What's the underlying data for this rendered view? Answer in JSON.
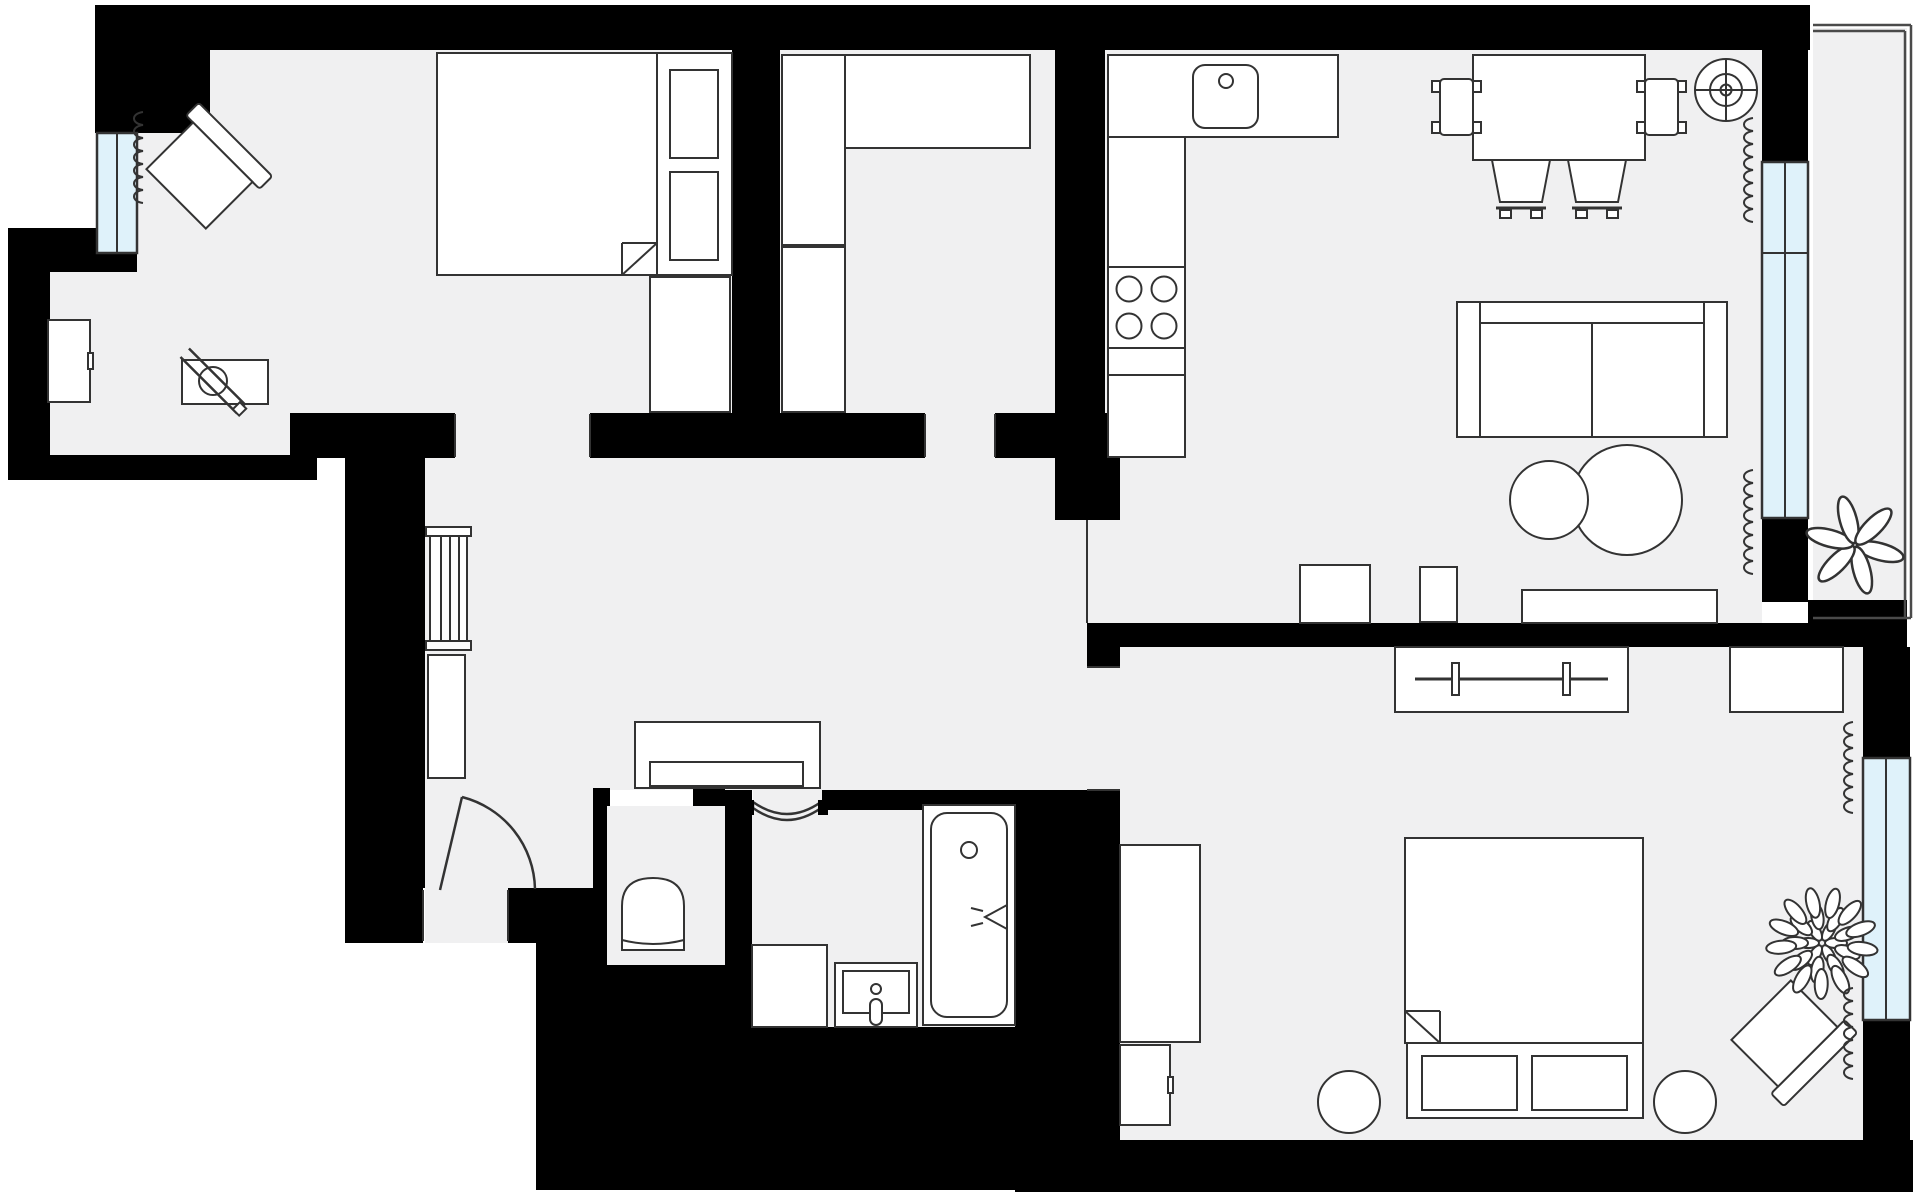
{
  "meta": {
    "title": "apartment-floor-plan",
    "kind": "architectural-floor-plan-top-view",
    "rooms": [
      "bedroom-1",
      "walk-in-closet",
      "kitchen-living",
      "hallway",
      "wc",
      "bathroom",
      "bedroom-2",
      "balcony"
    ]
  },
  "canvas": {
    "w": 1920,
    "h": 1195,
    "bg": "#ffffff"
  },
  "palette": {
    "wall": "#000000",
    "floor": "#f0f0f1",
    "furniture_fill": "#ffffff",
    "line": "#333333",
    "window_fill": "#dff2fa",
    "rail": "#4a4a4a"
  },
  "floors": [
    {
      "room": "bedroom-1",
      "rects": [
        [
          135,
          50,
          732,
          413
        ],
        [
          50,
          272,
          135,
          455
        ],
        [
          135,
          413,
          290,
          455
        ],
        [
          455,
          413,
          590,
          458
        ]
      ]
    },
    {
      "room": "walk-in-closet",
      "rects": [
        [
          780,
          50,
          1055,
          413
        ],
        [
          925,
          413,
          995,
          458
        ]
      ]
    },
    {
      "room": "kitchen-living",
      "rects": [
        [
          1087,
          50,
          1762,
          623
        ]
      ]
    },
    {
      "room": "hallway",
      "rects": [
        [
          425,
          458,
          1087,
          790
        ],
        [
          425,
          790,
          593,
          943
        ],
        [
          1087,
          647,
          1120,
          790
        ]
      ]
    },
    {
      "room": "wc",
      "rects": [
        [
          607,
          806,
          725,
          965
        ]
      ]
    },
    {
      "room": "bathroom",
      "rects": [
        [
          752,
          810,
          1015,
          1027
        ],
        [
          753,
          790,
          822,
          810
        ]
      ]
    },
    {
      "room": "bedroom-2",
      "rects": [
        [
          1120,
          647,
          1863,
          1140
        ]
      ]
    },
    {
      "room": "balcony",
      "rects": [
        [
          1813,
          28,
          1907,
          618
        ]
      ]
    }
  ],
  "walls": [
    [
      95,
      5,
      1810,
      50
    ],
    [
      95,
      5,
      210,
      133
    ],
    [
      97,
      253,
      137,
      272
    ],
    [
      8,
      228,
      97,
      272
    ],
    [
      8,
      272,
      50,
      480
    ],
    [
      8,
      455,
      317,
      480
    ],
    [
      290,
      413,
      455,
      458
    ],
    [
      590,
      413,
      925,
      458
    ],
    [
      995,
      413,
      1055,
      458
    ],
    [
      732,
      50,
      780,
      413
    ],
    [
      1055,
      50,
      1105,
      413
    ],
    [
      1055,
      413,
      1120,
      520
    ],
    [
      345,
      458,
      425,
      888
    ],
    [
      345,
      888,
      423,
      943
    ],
    [
      508,
      888,
      600,
      943
    ],
    [
      536,
      930,
      607,
      1190
    ],
    [
      607,
      965,
      725,
      1190
    ],
    [
      725,
      1027,
      1015,
      1190
    ],
    [
      593,
      788,
      610,
      806
    ],
    [
      693,
      788,
      725,
      806
    ],
    [
      593,
      806,
      607,
      965
    ],
    [
      725,
      790,
      752,
      1027
    ],
    [
      822,
      790,
      1015,
      810
    ],
    [
      1015,
      790,
      1120,
      1140
    ],
    [
      1087,
      623,
      1120,
      667
    ],
    [
      1087,
      623,
      1810,
      647
    ],
    [
      1762,
      50,
      1808,
      162
    ],
    [
      1762,
      518,
      1808,
      602
    ],
    [
      1808,
      600,
      1907,
      647
    ],
    [
      1863,
      647,
      1910,
      758
    ],
    [
      1863,
      1020,
      1910,
      1140
    ],
    [
      1015,
      1140,
      1913,
      1192
    ]
  ],
  "windows": [
    {
      "name": "window-bedroom-1",
      "x": 97,
      "y": 133,
      "w": 40,
      "h": 120,
      "dividers": [
        [
          "v",
          117,
          133,
          253
        ]
      ]
    },
    {
      "name": "window-living",
      "x": 1762,
      "y": 162,
      "w": 46,
      "h": 356,
      "dividers": [
        [
          "v",
          1785,
          162,
          518
        ],
        [
          "h",
          1762,
          1808,
          253
        ]
      ]
    },
    {
      "name": "window-bedroom-2",
      "x": 1863,
      "y": 758,
      "w": 47,
      "h": 262,
      "dividers": [
        [
          "v",
          1886,
          758,
          1020
        ]
      ]
    }
  ],
  "balcony_rail": [
    [
      1813,
      25,
      1911,
      25
    ],
    [
      1911,
      25,
      1911,
      618
    ],
    [
      1813,
      31,
      1905,
      31
    ],
    [
      1905,
      31,
      1905,
      618
    ],
    [
      1813,
      618,
      1911,
      618
    ]
  ],
  "jambs": [
    [
      1087,
      520,
      1087,
      623
    ],
    [
      455,
      414,
      455,
      457
    ],
    [
      590,
      414,
      590,
      457
    ],
    [
      925,
      414,
      925,
      457
    ],
    [
      995,
      414,
      995,
      457
    ],
    [
      423,
      890,
      423,
      941
    ],
    [
      508,
      890,
      508,
      941
    ],
    [
      1087,
      667,
      1120,
      667
    ],
    [
      1087,
      790,
      1120,
      790
    ]
  ],
  "curtains": [
    {
      "name": "curtain-bedroom-1",
      "x": 143,
      "y1": 112,
      "y2": 210
    },
    {
      "name": "curtain-living-top",
      "x": 1753,
      "y1": 118,
      "y2": 228
    },
    {
      "name": "curtain-living-bottom",
      "x": 1753,
      "y1": 470,
      "y2": 585
    },
    {
      "name": "curtain-bedroom-2-top",
      "x": 1853,
      "y1": 722,
      "y2": 818
    },
    {
      "name": "curtain-bedroom-2-bottom",
      "x": 1853,
      "y1": 988,
      "y2": 1088
    }
  ],
  "doors": [
    {
      "name": "entry-door",
      "kind": "swing",
      "leaf": [
        440,
        890,
        462,
        797
      ],
      "arc": [
        462,
        797,
        97,
        535,
        889
      ]
    },
    {
      "name": "bathroom-door",
      "kind": "curved",
      "from": [
        753,
        808
      ],
      "to": [
        821,
        808
      ],
      "dip": 24,
      "jambs": [
        [
          744,
          800,
          10,
          15
        ],
        [
          818,
          800,
          10,
          15
        ]
      ]
    }
  ],
  "furniture": [
    {
      "type": "bed",
      "name": "bed-1",
      "x": 437,
      "y": 53,
      "w": 220,
      "h": 222,
      "fold": "br"
    },
    {
      "type": "rect",
      "name": "bed-1-side-platform",
      "x": 657,
      "y": 53,
      "w": 75,
      "h": 222
    },
    {
      "type": "rect",
      "name": "nightstand-upper",
      "x": 670,
      "y": 70,
      "w": 48,
      "h": 88
    },
    {
      "type": "rect",
      "name": "nightstand-lower",
      "x": 670,
      "y": 172,
      "w": 48,
      "h": 88
    },
    {
      "type": "rect",
      "name": "dresser-bedroom-1",
      "x": 650,
      "y": 277,
      "w": 80,
      "h": 135
    },
    {
      "type": "armchair",
      "name": "armchair-bedroom-1",
      "cx": 203,
      "cy": 172,
      "rot": 45
    },
    {
      "type": "rect",
      "name": "desk-bedroom-1",
      "x": 182,
      "y": 360,
      "w": 86,
      "h": 44
    },
    {
      "type": "desk_chair",
      "name": "desk-chair-bedroom-1",
      "cx": 213,
      "cy": 381,
      "rot": 45
    },
    {
      "type": "cabinet",
      "name": "cabinet-alcove",
      "x": 48,
      "y": 320,
      "w": 42,
      "h": 82,
      "handle": "right"
    },
    {
      "type": "rect",
      "name": "wardrobe-closet-upper",
      "x": 782,
      "y": 55,
      "w": 63,
      "h": 190
    },
    {
      "type": "rect",
      "name": "wardrobe-closet-lower",
      "x": 782,
      "y": 247,
      "w": 63,
      "h": 165
    },
    {
      "type": "rect",
      "name": "closet-shelf",
      "x": 845,
      "y": 55,
      "w": 185,
      "h": 93
    },
    {
      "type": "counter_sink",
      "name": "kitchen-counter-sink",
      "x": 1108,
      "y": 55,
      "w": 230,
      "h": 82,
      "sink": [
        1193,
        65,
        65,
        63
      ],
      "faucet": [
        1226,
        81,
        7
      ]
    },
    {
      "type": "rect",
      "name": "kitchen-cabinet-tall",
      "x": 1108,
      "y": 137,
      "w": 77,
      "h": 130
    },
    {
      "type": "stove",
      "name": "kitchen-stove",
      "x": 1108,
      "y": 267,
      "w": 77,
      "h": 81,
      "burners": [
        [
          1129,
          289,
          12.5
        ],
        [
          1164,
          289,
          12.5
        ],
        [
          1129,
          326,
          12.5
        ],
        [
          1164,
          326,
          12.5
        ]
      ]
    },
    {
      "type": "rect",
      "name": "kitchen-counter-segment",
      "x": 1108,
      "y": 348,
      "w": 77,
      "h": 27
    },
    {
      "type": "rect",
      "name": "kitchen-cabinet-lower",
      "x": 1108,
      "y": 375,
      "w": 77,
      "h": 82
    },
    {
      "type": "rect",
      "name": "dining-table",
      "x": 1473,
      "y": 55,
      "w": 172,
      "h": 105
    },
    {
      "type": "chair",
      "name": "dining-chair-left",
      "x": 1440,
      "y": 79,
      "w": 33,
      "h": 56,
      "orient": "left"
    },
    {
      "type": "chair",
      "name": "dining-chair-right",
      "x": 1645,
      "y": 79,
      "w": 33,
      "h": 56,
      "orient": "right"
    },
    {
      "type": "chair",
      "name": "dining-chair-bottom-1",
      "x": 1492,
      "y": 160,
      "w": 58,
      "h": 42,
      "orient": "down"
    },
    {
      "type": "chair",
      "name": "dining-chair-bottom-2",
      "x": 1568,
      "y": 160,
      "w": 58,
      "h": 42,
      "orient": "down"
    },
    {
      "type": "fan",
      "name": "ceiling-fan-symbol",
      "cx": 1726,
      "cy": 90
    },
    {
      "type": "sofa",
      "name": "sofa",
      "x": 1457,
      "y": 302,
      "w": 270,
      "h": 135
    },
    {
      "type": "circle",
      "name": "coffee-table-large",
      "cx": 1627,
      "cy": 500,
      "r": 55
    },
    {
      "type": "circle",
      "name": "coffee-table-small",
      "cx": 1549,
      "cy": 500,
      "r": 39
    },
    {
      "type": "rect",
      "name": "tv-stand",
      "x": 1522,
      "y": 590,
      "w": 195,
      "h": 33
    },
    {
      "type": "rect",
      "name": "cabinet-living-left",
      "x": 1420,
      "y": 567,
      "w": 37,
      "h": 55
    },
    {
      "type": "rect",
      "name": "cabinet-living-square",
      "x": 1300,
      "y": 565,
      "w": 70,
      "h": 58
    },
    {
      "type": "radiator",
      "name": "hallway-radiator",
      "x": 430,
      "y": 536,
      "w": 37,
      "h": 105
    },
    {
      "type": "rect",
      "name": "hallway-cabinet",
      "x": 428,
      "y": 655,
      "w": 37,
      "h": 123
    },
    {
      "type": "console",
      "name": "hallway-console",
      "x": 635,
      "y": 722,
      "w": 185,
      "h": 66,
      "drawer": [
        650,
        762,
        153,
        24
      ]
    },
    {
      "type": "toilet",
      "name": "toilet",
      "cx": 653,
      "top": 878,
      "w": 62,
      "bottom": 950
    },
    {
      "type": "rect",
      "name": "washing-machine",
      "x": 752,
      "y": 945,
      "w": 75,
      "h": 82
    },
    {
      "type": "sink_bath",
      "name": "bathroom-sink",
      "x": 835,
      "y": 963,
      "w": 82,
      "h": 64
    },
    {
      "type": "bathtub",
      "name": "bathtub",
      "x": 923,
      "y": 805,
      "w": 92,
      "h": 220
    },
    {
      "type": "wardrobe_rail",
      "name": "wardrobe-bedroom-2",
      "x": 1395,
      "y": 647,
      "w": 233,
      "h": 65
    },
    {
      "type": "rect",
      "name": "desk-bedroom-2",
      "x": 1730,
      "y": 647,
      "w": 113,
      "h": 65
    },
    {
      "type": "bed",
      "name": "bed-2",
      "x": 1405,
      "y": 838,
      "w": 238,
      "h": 205,
      "fold": "bl"
    },
    {
      "type": "bench",
      "name": "bed-2-bench",
      "x": 1407,
      "y": 1043,
      "w": 236,
      "h": 75,
      "cushions": [
        [
          1422,
          1056,
          95,
          54
        ],
        [
          1532,
          1056,
          95,
          54
        ]
      ]
    },
    {
      "type": "circle",
      "name": "stool-left",
      "cx": 1349,
      "cy": 1102,
      "r": 31
    },
    {
      "type": "circle",
      "name": "stool-right",
      "cx": 1685,
      "cy": 1102,
      "r": 31
    },
    {
      "type": "rect",
      "name": "cabinet-tall-bedroom-2",
      "x": 1120,
      "y": 845,
      "w": 80,
      "h": 197
    },
    {
      "type": "cabinet",
      "name": "cabinet-small-bedroom-2",
      "x": 1120,
      "y": 1045,
      "w": 50,
      "h": 80,
      "handle": "right"
    },
    {
      "type": "armchair",
      "name": "armchair-bedroom-2",
      "cx": 1788,
      "cy": 1037,
      "rot": 135
    },
    {
      "type": "plant_bush",
      "name": "plant-bedroom-2",
      "cx": 1822,
      "cy": 943
    },
    {
      "type": "plant_star",
      "name": "plant-balcony",
      "cx": 1855,
      "cy": 545
    }
  ]
}
